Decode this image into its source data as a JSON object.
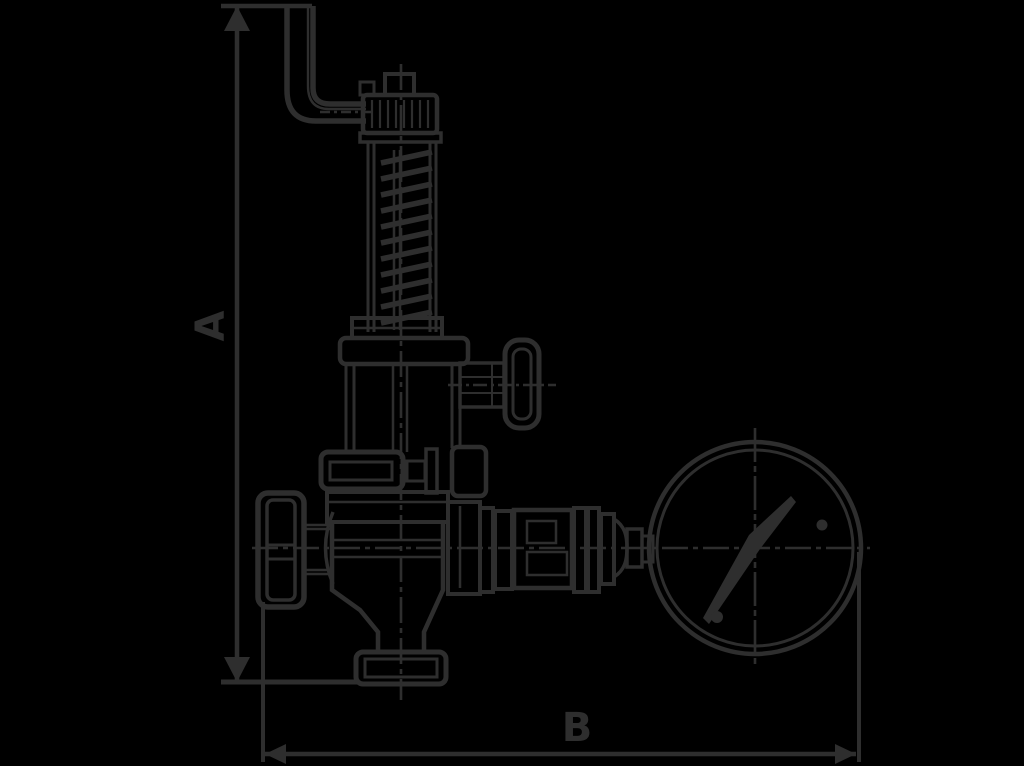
{
  "diagram": {
    "type": "technical-line-drawing",
    "subject": "spring-loaded safety relief valve, side elevation, with vent pipe, test knob, handwheel and pressure gauge",
    "colors": {
      "background": "#000000",
      "line": "#2e2e2e"
    },
    "dimensions": {
      "vertical": {
        "label": "A",
        "orientation": "rotated-90-ccw"
      },
      "horizontal": {
        "label": "B",
        "orientation": "horizontal"
      }
    },
    "components": [
      "vent-pipe-elbow",
      "union-nut",
      "open-spring-bonnet-with-spring",
      "test-knob",
      "mid-flange",
      "valve-body",
      "handwheel",
      "outlet-foot-flange",
      "piping-run-with-unions",
      "pressure-gauge-with-needle"
    ]
  }
}
